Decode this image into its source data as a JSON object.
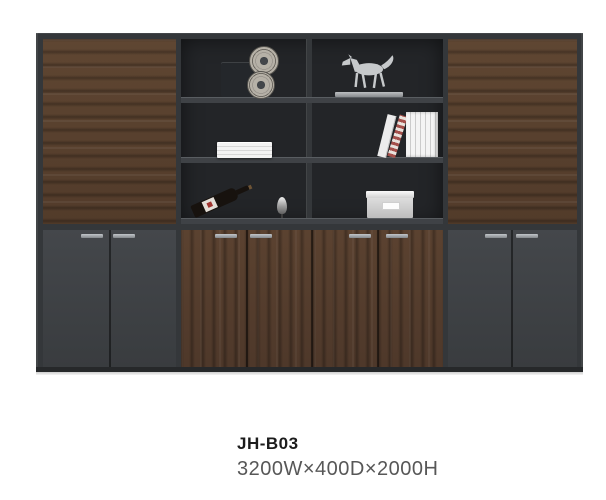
{
  "product": {
    "model": "JH-B03",
    "dimensions": "3200W×400D×2000H"
  },
  "image": {
    "type": "product-photo",
    "subject": "wall cabinet with wood doors, gray doors and open display shelves",
    "decor_items": [
      "film-projector",
      "horse-statue",
      "flat-book-stack",
      "upright-books",
      "wine-bottle",
      "silver-stopper",
      "storage-box"
    ]
  },
  "colors": {
    "background": "#ffffff",
    "frame": "#34373a",
    "wood": "#59412f",
    "gray_door": "#3e4144",
    "shelf_back": "#232528",
    "handle": "#a7acb0",
    "model_text": "#1c1c1c",
    "dimensions_text": "#575757"
  }
}
